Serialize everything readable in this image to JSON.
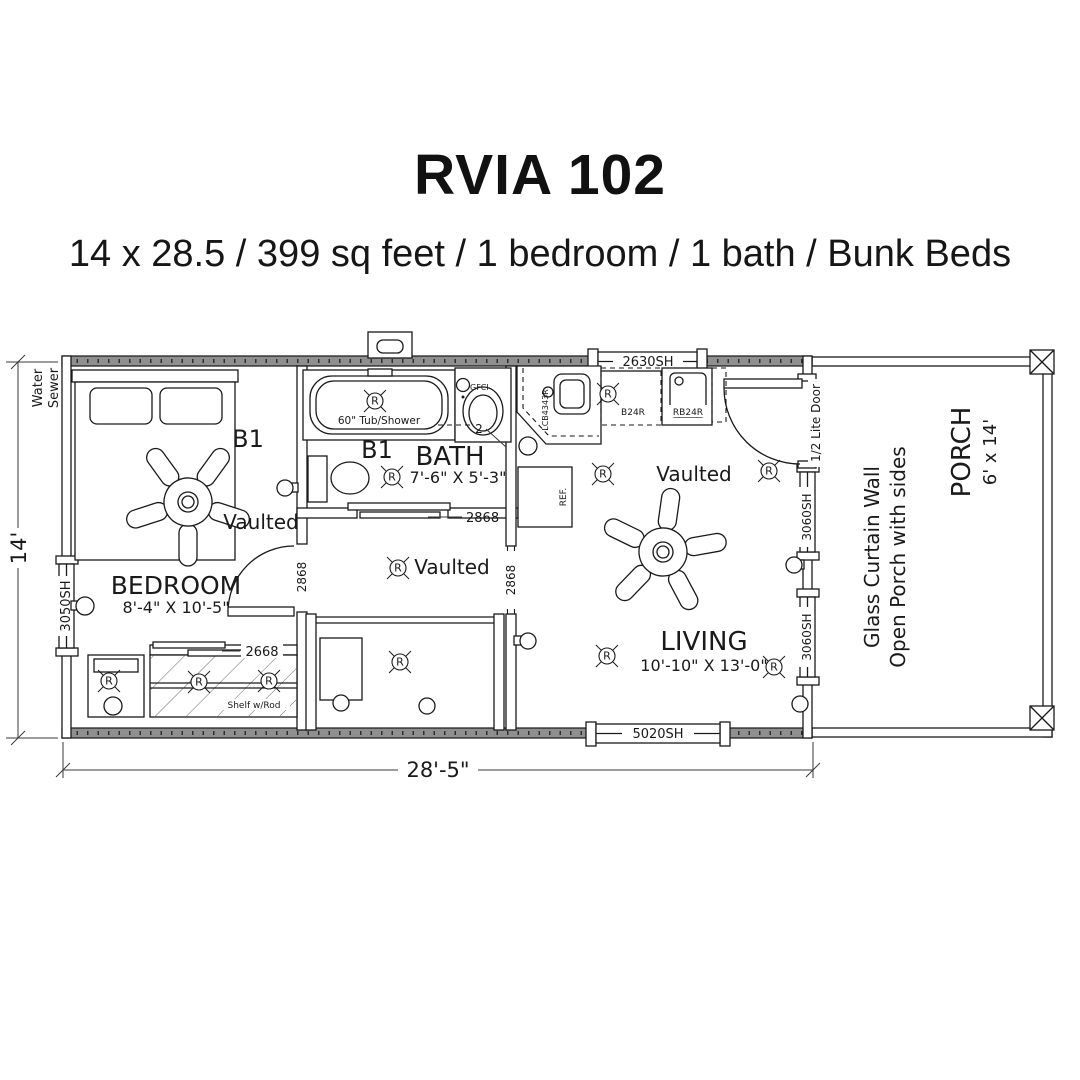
{
  "header": {
    "title": "RVIA 102",
    "subtitle": "14 x 28.5 / 399 sq feet / 1 bedroom / 1 bath / Bunk Beds"
  },
  "dimensions": {
    "overall_width": "28'-5\"",
    "overall_depth": "14'"
  },
  "site_labels": {
    "water": "Water",
    "sewer": "Sewer"
  },
  "rooms": {
    "bedroom": {
      "name": "BEDROOM",
      "size": "8'-4\" X 10'-5\"",
      "ceiling": "Vaulted",
      "bunk_label": "B1"
    },
    "bath": {
      "name": "BATH",
      "size": "7'-6\" X 5'-3\"",
      "bunk_label": "B1",
      "tub_label": "60\" Tub/Shower",
      "gfci_label": "GFCI",
      "callout": "2"
    },
    "hallway": {
      "ceiling": "Vaulted"
    },
    "living": {
      "name": "LIVING",
      "size": "10'-10\" X 13'-0\"",
      "ceiling": "Vaulted"
    },
    "porch": {
      "name": "PORCH",
      "size": "6' x 14'",
      "wall_note_line1": "Glass Curtain Wall",
      "wall_note_line2": "Open Porch with sides"
    }
  },
  "windows": {
    "bedroom_left": "3050SH",
    "kitchen_top": "2630SH",
    "living_bottom": "5020SH",
    "living_right_upper": "3060SH",
    "living_right_lower": "3060SH"
  },
  "doors": {
    "bedroom": "2868",
    "bath": "2868",
    "living_opening": "2868",
    "closet": "2668",
    "porch": "1/2 Lite Door"
  },
  "closet": {
    "label": "Shelf w/Rod"
  },
  "kitchen": {
    "cabinet_b24r": "B24R",
    "sink_base": "RB24R",
    "corner_cabinet": "LCB4343R",
    "fridge": "REF."
  },
  "symbols": {
    "receptacle": "R"
  }
}
